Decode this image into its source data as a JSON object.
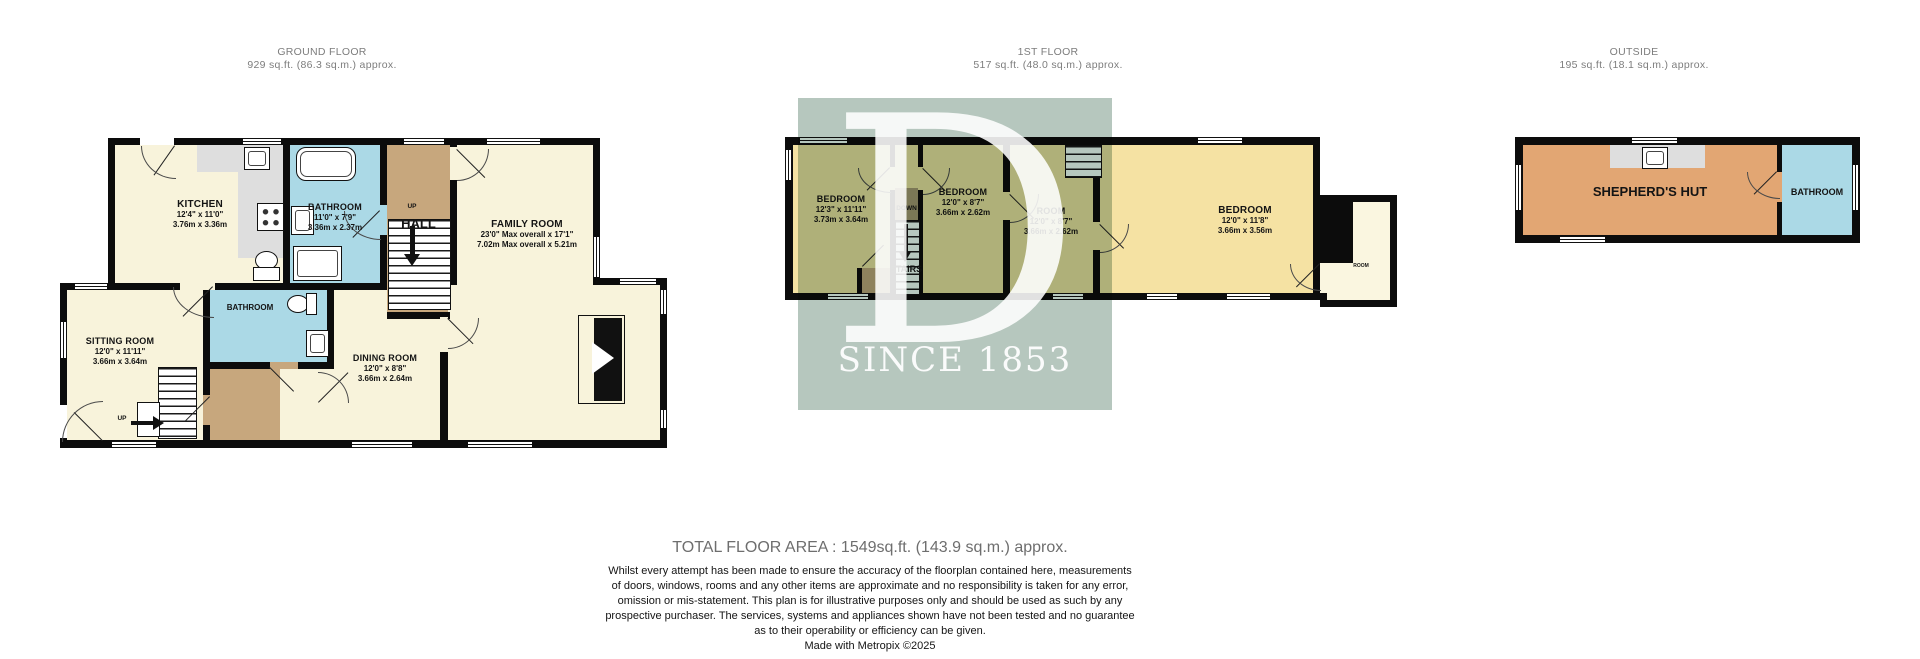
{
  "sections": {
    "ground": {
      "title": "GROUND FLOOR",
      "area": "929 sq.ft. (86.3 sq.m.) approx."
    },
    "first": {
      "title": "1ST FLOOR",
      "area": "517 sq.ft. (48.0 sq.m.) approx."
    },
    "outside": {
      "title": "OUTSIDE",
      "area": "195 sq.ft. (18.1 sq.m.) approx."
    }
  },
  "ground": {
    "kitchen": {
      "name": "KITCHEN",
      "ft": "12'4\" x 11'0\"",
      "m": "3.76m x 3.36m"
    },
    "bathroom": {
      "name": "BATHROOM",
      "ft": "11'0\" x 7'9\"",
      "m": "3.36m x 2.37m"
    },
    "hall": {
      "name": "HALL",
      "up": "UP"
    },
    "family": {
      "name": "FAMILY ROOM",
      "ft": "23'0\" Max overall x 17'1\"",
      "m": "7.02m Max overall x 5.21m"
    },
    "sitting": {
      "name": "SITTING ROOM",
      "ft": "12'0\" x 11'11\"",
      "m": "3.66m x 3.64m"
    },
    "bathroom2": {
      "name": "BATHROOM"
    },
    "dining": {
      "name": "DINING ROOM",
      "ft": "12'0\" x 8'8\"",
      "m": "3.66m x 2.64m"
    },
    "up2": "UP"
  },
  "first": {
    "bedroom1": {
      "name": "BEDROOM",
      "ft": "12'3\" x 11'11\"",
      "m": "3.73m x 3.64m"
    },
    "stairs": {
      "down": "DOWN",
      "label": "STAIRS"
    },
    "bedroom2": {
      "name": "BEDROOM",
      "ft": "12'0\" x 8'7\"",
      "m": "3.66m x 2.62m"
    },
    "room": {
      "name": "ROOM",
      "ft": "12'0\" x 8'7\"",
      "m": "3.66m x 2.62m"
    },
    "bedroom3": {
      "name": "BEDROOM",
      "ft": "12'0\" x 11'8\"",
      "m": "3.66m x 3.56m"
    },
    "room_small": "ROOM"
  },
  "outside": {
    "hut": "SHEPHERD'S HUT",
    "bathroom": "BATHROOM"
  },
  "watermark": {
    "letter": "D",
    "caption": "SINCE 1853"
  },
  "footer": {
    "total": "TOTAL FLOOR AREA : 1549sq.ft. (143.9 sq.m.) approx.",
    "line1": "Whilst every attempt has been made to ensure the accuracy of the floorplan contained here, measurements",
    "line2": "of doors, windows, rooms and any other items are approximate and no responsibility is taken for any error,",
    "line3": "omission or mis-statement. This plan is for illustrative purposes only and should be used as such by any",
    "line4": "prospective purchaser. The services, systems and appliances shown have not been tested and no guarantee",
    "line5": "as to their operability or efficiency can be given.",
    "credit": "Made with Metropix ©2025"
  },
  "colors": {
    "wall": "#0c0c0c",
    "room_cream": "#F8F3DB",
    "room_gold": "#F5E2A3",
    "bath_blue": "#ABD9E6",
    "hall_tan": "#C7A77D",
    "landing_brown": "#AD9973",
    "hut_orange": "#E2A673",
    "counter_grey": "#DEDEDE",
    "watermark": "#B6C7BE"
  }
}
